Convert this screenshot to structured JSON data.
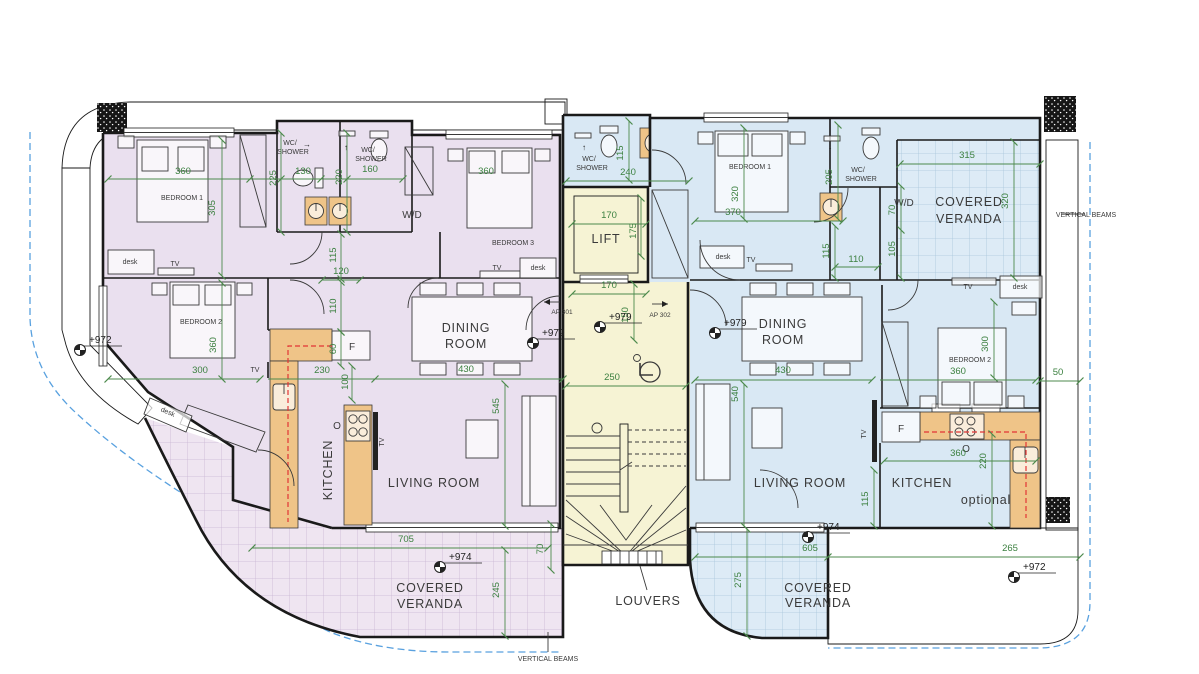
{
  "plan": {
    "apartments": {
      "left_id": "AP 301",
      "right_id": "AP 302"
    },
    "rooms": {
      "bedroom1": "BEDROOM 1",
      "bedroom2": "BEDROOM 2",
      "bedroom3": "BEDROOM 3",
      "dining_1": "DINING",
      "dining_2": "ROOM",
      "living": "LIVING ROOM",
      "kitchen": "KITCHEN",
      "wc_1": "WC/",
      "wc_2": "SHOWER",
      "lift": "LIFT",
      "veranda_1": "COVERED",
      "veranda_2": "VERANDA"
    },
    "fixtures": {
      "desk": "desk",
      "tv": "TV",
      "wd": "W/D",
      "fridge": "F",
      "oven": "O",
      "optional": "optional"
    },
    "annotations": {
      "louvers": "LOUVERS",
      "vertical_beams": "VERTICAL BEAMS"
    },
    "levels": {
      "l972": "+972",
      "l974": "+974",
      "l979": "+979"
    },
    "dims": {
      "d50": "50",
      "d60": "60",
      "d70": "70",
      "d100": "100",
      "d105": "105",
      "d110": "110",
      "d115": "115",
      "d120": "120",
      "d130": "130",
      "d150": "150",
      "d160": "160",
      "d170": "170",
      "d175": "175",
      "d205": "205",
      "d220": "220",
      "d225": "225",
      "d230": "230",
      "d240": "240",
      "d245": "245",
      "d250": "250",
      "d265": "265",
      "d275": "275",
      "d300": "300",
      "d305": "305",
      "d315": "315",
      "d320": "320",
      "d360": "360",
      "d370": "370",
      "d430": "430",
      "d540": "540",
      "d545": "545",
      "d605": "605",
      "d705": "705"
    },
    "colors": {
      "apartment_left": "#EAE0EF",
      "apartment_right": "#D9E8F4",
      "core": "#F6F3D4",
      "counter": "#EFC488",
      "dimension_green": "#4C8A4C",
      "wall_black": "#1a1a1a",
      "boundary_blue": "#59A1DF",
      "optional_red": "#E23535"
    }
  }
}
